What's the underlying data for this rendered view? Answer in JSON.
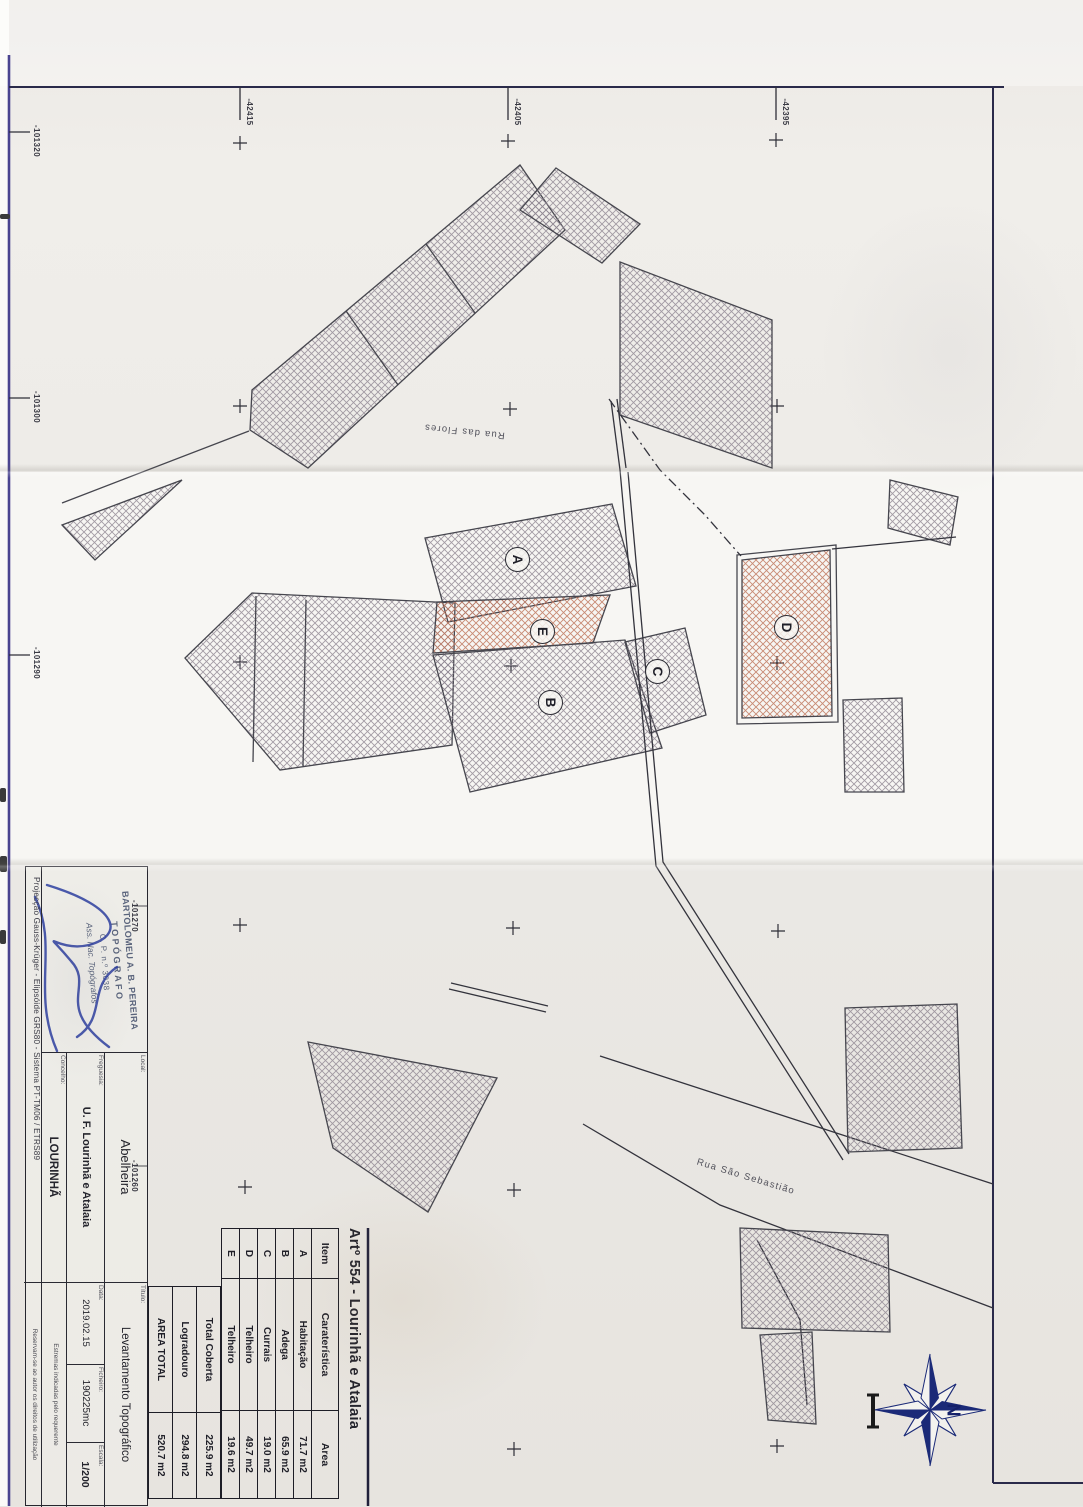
{
  "sheet": {
    "article_title": "Artº 554 - Lourinhã e Atalaia",
    "street_1": "Rua das Flores",
    "street_2": "Rua São Sebastião"
  },
  "area_table": {
    "headers": [
      "Item",
      "Caraterística",
      "Area"
    ],
    "rows": [
      [
        "A",
        "Habitação",
        "71.7 m2"
      ],
      [
        "B",
        "Adega",
        "65.9 m2"
      ],
      [
        "C",
        "Currais",
        "19.0 m2"
      ],
      [
        "D",
        "Telheiro",
        "49.7 m2"
      ],
      [
        "E",
        "Telheiro",
        "19.6 m2"
      ]
    ],
    "summary": [
      [
        "Total Coberta",
        "225.9 m2"
      ],
      [
        "Logradouro",
        "294.8 m2"
      ],
      [
        "AREA TOTAL",
        "520.7 m2"
      ]
    ]
  },
  "title_block": {
    "local_label": "Local:",
    "local_value": "Abelheira",
    "freguesia_label": "Freguesia:",
    "freguesia_value": "U. F. Lourinhã e Atalaia",
    "concelho_label": "Concelho:",
    "concelho_value": "LOURINHÃ",
    "titulo_label": "Título:",
    "titulo_value": "Levantamento Topográfico",
    "ficheiro_label": "Ficheiro:",
    "ficheiro_value": "190225mc",
    "data_label": "Data:",
    "data_value": "2019.02.15",
    "escala_label": "Escala:",
    "escala_value": "1/200",
    "projection_line": "Projecção Gauss-Krüger - Elipsóide GRS80 - Sistema PT-TM06 / ETRS89",
    "note_1": "Estremas indicadas pelo requerente",
    "note_2": "Reservam-se ao autor os direitos de utilização",
    "stamp_line_1": "BARTOLOMEU A. B. PEREIRA",
    "stamp_line_2": "TOPÓGRAFO",
    "stamp_line_3": "C. P. n.º 3038",
    "stamp_line_4": "Ass. Nac. Topógrafos"
  },
  "coordinates": {
    "left_ticks": [
      "-101320",
      "-101300",
      "-101290",
      "-101270",
      "-101260"
    ],
    "top_ticks": [
      "-42415",
      "-42405",
      "-42395"
    ]
  },
  "buildings": [
    {
      "label": "A",
      "name": "Habitação"
    },
    {
      "label": "B",
      "name": "Adega"
    },
    {
      "label": "C",
      "name": "Currais"
    },
    {
      "label": "D",
      "name": "Telheiro"
    },
    {
      "label": "E",
      "name": "Telheiro"
    }
  ],
  "compass": {
    "north_label": "N"
  },
  "colors": {
    "hatch_grey": "#8d8490",
    "hatch_red": "#c0785f",
    "frame_indigo": "#4a4490",
    "ink": "#26262e",
    "signature_blue": "#2d3fa0"
  }
}
